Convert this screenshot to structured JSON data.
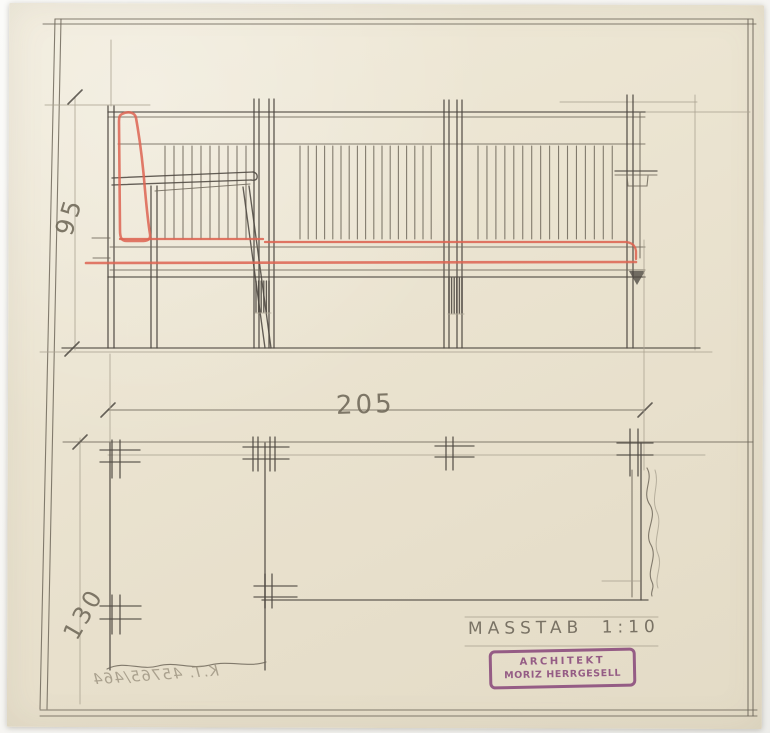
{
  "sheet": {
    "dimension_labels": {
      "height": "95",
      "length": "205",
      "depth": "130"
    },
    "scale_note": "MASSTAB 1:10",
    "stamp": {
      "line1": "ARCHITEKT",
      "line2": "MORIZ HERRGESELL"
    },
    "reference_number": "K.T. 45765/464"
  },
  "colors": {
    "background": "#f7f6f4",
    "paper": "#eae2cf",
    "pencil_dark": "#4e4942",
    "pencil_medium": "#6e675a",
    "pencil_light": "#aaa291",
    "accent_red": "#dd6452",
    "stamp_purple": "#8a4b7c",
    "handwriting": "#6f6858"
  }
}
